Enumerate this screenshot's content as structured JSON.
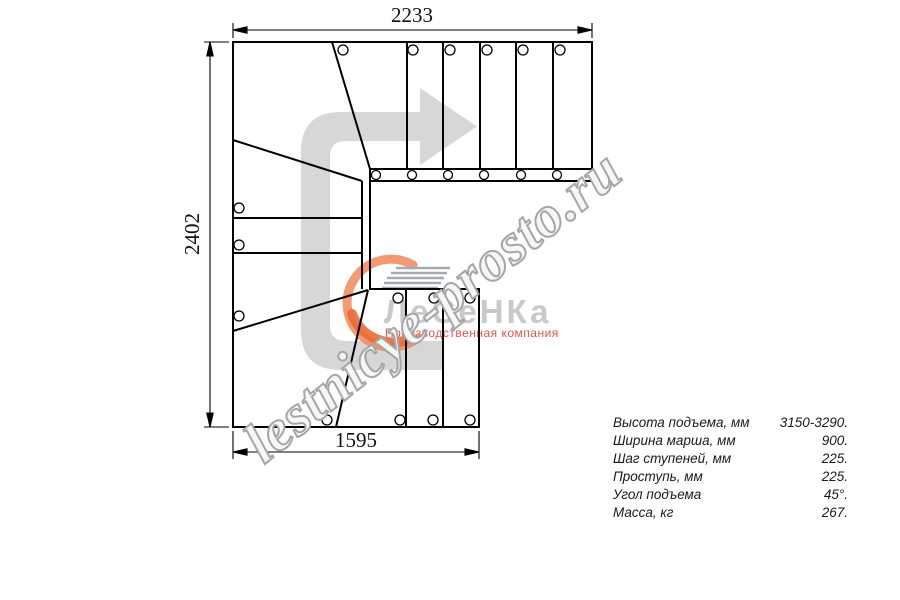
{
  "drawing": {
    "dim_top": "2233",
    "dim_left": "2402",
    "dim_bottom": "1595"
  },
  "watermark": {
    "text": "lestnicye-prosto.ru"
  },
  "logo": {
    "name": "ЛеСеНКа",
    "tagline": "Производственная компания"
  },
  "specs": {
    "rows": [
      {
        "label": "Высота подъема, мм",
        "value": "3150-3290."
      },
      {
        "label": "Ширина марша, мм",
        "value": "900."
      },
      {
        "label": "Шаг ступеней, мм",
        "value": "225."
      },
      {
        "label": "Проступь, мм",
        "value": "225."
      },
      {
        "label": "Угол подъема",
        "value": "45°."
      },
      {
        "label": "Масса, кг",
        "value": "267."
      }
    ]
  },
  "colors": {
    "arrow": "#d7d7d7",
    "line": "#000000",
    "logo_orange": "#f1875c",
    "logo_orange_dark": "#ea6a35",
    "logo_gray": "#c9c9c9",
    "tagline_red": "#e0544a"
  }
}
